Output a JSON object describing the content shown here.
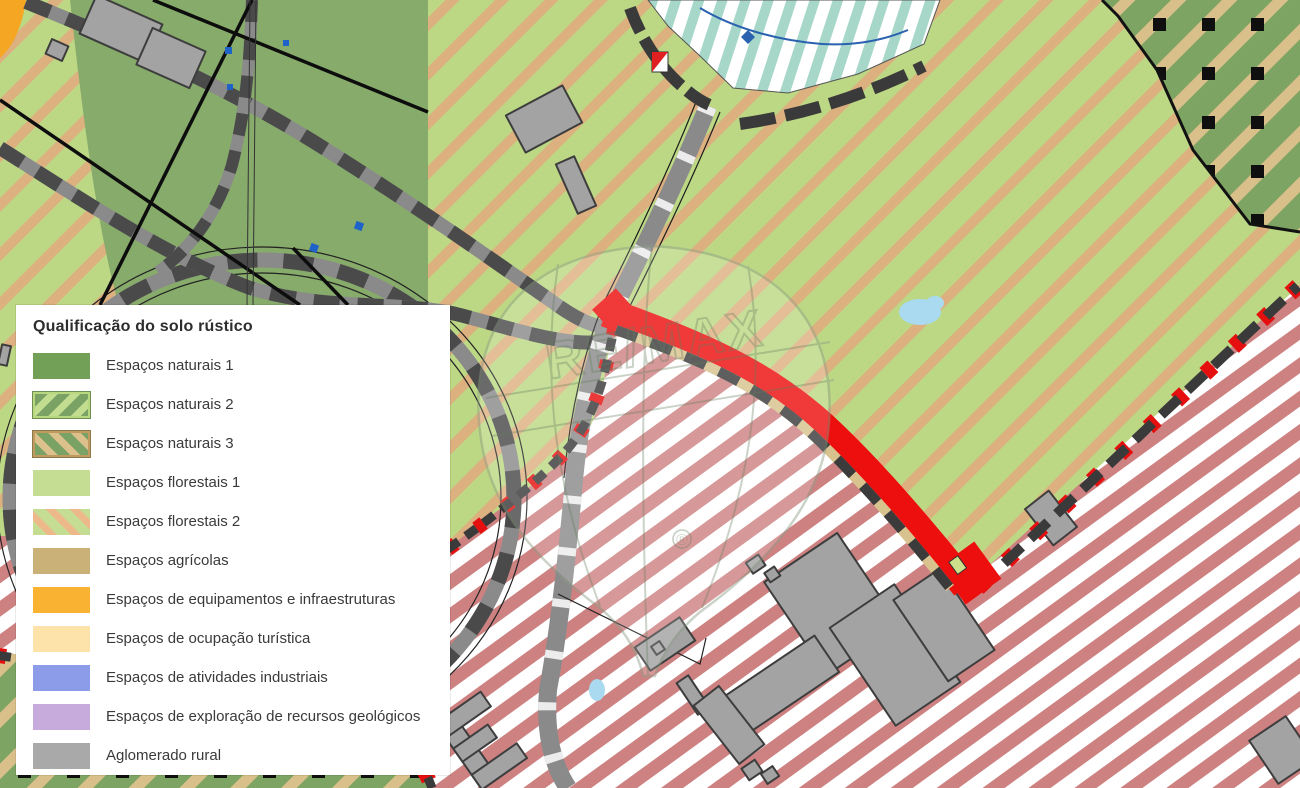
{
  "legend": {
    "title": "Qualificação do solo rústico",
    "items": [
      {
        "label": "Espaços naturais 1",
        "swatch": "solid",
        "color": "#73a057"
      },
      {
        "label": "Espaços naturais 2",
        "swatch": "light-green-stripes",
        "color": "#7ba265",
        "stripe_color": "#c3dd90"
      },
      {
        "label": "Espaços naturais 3",
        "swatch": "tan-stripes",
        "color": "#7ba265",
        "stripe_color": "#ddc18c"
      },
      {
        "label": "Espaços florestais 1",
        "swatch": "solid",
        "color": "#c5dd92"
      },
      {
        "label": "Espaços florestais 2",
        "swatch": "salmon-stripes",
        "color": "#c5dd92",
        "stripe_color": "#edb98b"
      },
      {
        "label": "Espaços agrícolas",
        "swatch": "solid",
        "color": "#c9b178"
      },
      {
        "label": "Espaços de equipamentos e infraestruturas",
        "swatch": "solid",
        "color": "#f9b231"
      },
      {
        "label": "Espaços de ocupação turística",
        "swatch": "solid",
        "color": "#fde2a9"
      },
      {
        "label": "Espaços de atividades industriais",
        "swatch": "solid",
        "color": "#8d9ce8"
      },
      {
        "label": "Espaços de exploração de recursos geológicos",
        "swatch": "solid",
        "color": "#c7abdd"
      },
      {
        "label": "Aglomerado rural",
        "swatch": "solid",
        "color": "#a9a9a9"
      }
    ]
  },
  "watermark": {
    "brand": "RE/MAX",
    "registered": "®"
  },
  "map": {
    "colors": {
      "forest_light_green": "#bcd884",
      "forest_stripe_salmon": "#ddb07f",
      "natural_solid_green": "#87ab6b",
      "natural3_green": "#7da463",
      "natural3_stripe_tan": "#d9bf8a",
      "dot_overlay_black": "#0f0f0f",
      "urban_stripe_rose": "#cd8181",
      "urban_background": "#ffffff",
      "teal_stripe": "#a6d7c9",
      "road_gray": "#8a8a8a",
      "road_dash_dark": "#4a4a4a",
      "property_boundary_red": "#ed0e0e",
      "water_blue": "#a9daf0",
      "equipment_orange": "#f5a623",
      "building_gray": "#a3a3a3"
    }
  }
}
